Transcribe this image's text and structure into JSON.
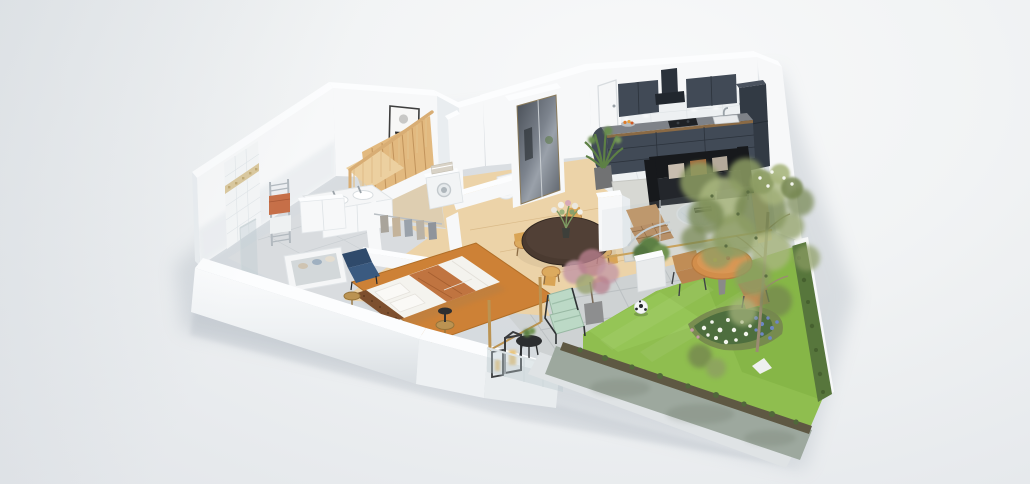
{
  "scene": {
    "label": "3D cutaway floor plan render of a one-bedroom apartment with terrace and private garden, isometric bird's-eye view on a light grey studio background",
    "rooms": {
      "kitchen": {
        "label": "Kitchen",
        "objects": [
          "dark slate fitted cabinets",
          "upper cabinets",
          "extractor hood",
          "cooktop",
          "sink with faucet",
          "tall fridge unit",
          "white tile backsplash with spotlights",
          "fruit bowl",
          "white tiled floor"
        ]
      },
      "entry": {
        "label": "Entry hall",
        "objects": [
          "white entrance door",
          "mirrored sliding wardrobe",
          "tall potted plant",
          "oak floor"
        ]
      },
      "dining_area": {
        "label": "Dining area",
        "objects": [
          "round espresso dining table",
          "four light wood chairs",
          "flower bouquet"
        ]
      },
      "living_room": {
        "label": "Living room",
        "objects": [
          "black three-seat sofa",
          "beige and cognac pillows",
          "round glass coffee table",
          "tan lounge chair",
          "light grey rug",
          "white column",
          "glass sliding wall"
        ]
      },
      "bedroom": {
        "label": "Bedroom",
        "objects": [
          "double bed with white duvet and terracotta throw",
          "brown tufted headboard",
          "orange rug",
          "dark blue armchair",
          "two brass side tables",
          "black table lamp",
          "white wardrobe"
        ]
      },
      "bathroom": {
        "label": "Bathroom",
        "objects": [
          "tiled shower wall with mosaic accent band",
          "glass shower screen",
          "towel radiator with orange and white towels",
          "double sink vanity",
          "bathtub with rolled towels",
          "grey tiled floor"
        ]
      },
      "wc": {
        "label": "WC",
        "objects": [
          "toilet"
        ]
      },
      "laundry": {
        "label": "Laundry nook",
        "objects": [
          "washing machine",
          "stack of folded towels"
        ]
      },
      "walk_in_closet": {
        "label": "Walk-in closet",
        "objects": [
          "clothes rail with hanging garments",
          "low white partition walls"
        ]
      },
      "staircase": {
        "label": "Staircase",
        "objects": [
          "light wood steps",
          "wood balustrade with balusters"
        ]
      },
      "terrace": {
        "label": "Terrace",
        "objects": [
          "concrete pavers",
          "mint green lounge chair",
          "black round side table",
          "two candle lanterns",
          "pink blossom potted tree",
          "white cube planter",
          "glass balustrade",
          "brass door frames",
          "round orange outdoor table",
          "two metal outdoor chairs"
        ]
      },
      "garden": {
        "label": "Garden",
        "objects": [
          "lawn",
          "flower bed with white and blue flowers",
          "large airy tree",
          "trimmed hedge",
          "soccer ball",
          "low concrete boundary wall with creeping plants",
          "white garden wall"
        ]
      }
    },
    "artwork": {
      "label": "Abstract wall art",
      "objects": [
        "grey circle",
        "black semicircle",
        "orange semicircle",
        "thin dark frame"
      ]
    }
  },
  "colors": {
    "wall_face": "#f7f8f9",
    "wall_side": "#e9edf0",
    "wall_top": "#fcfdfe",
    "floor_wood": "#ecd3a8",
    "floor_wood_dark": "#e2c491",
    "tile_white": "#eef1f2",
    "bath_floor": "#d9dcdf",
    "rug_living": "#d7d8d3",
    "rug_bedroom": "#cd8136",
    "kitchen_cabinet": "#414a56",
    "kitchen_cabinet_dark": "#323a44",
    "kitchen_counter": "#7e8288",
    "kitchen_hood": "#2b323b",
    "backsplash": "#edf0f2",
    "sofa_black": "#17191c",
    "sofa_cushion": "#23262b",
    "pillow_beige": "#c8bdaf",
    "pillow_cognac": "#a5693b",
    "chair_leather": "#b8895a",
    "bed_white": "#f4f3ee",
    "bed_throw": "#c07440",
    "headboard_brown": "#7d4f2e",
    "chair_blue": "#3a5a80",
    "brass": "#bb9352",
    "stairs_wood": "#e2b97f",
    "stairs_rail": "#d8ad74",
    "shower_tile": "#f3f5f6",
    "accent_tile": "#d9c79c",
    "towel_orange": "#c66f48",
    "towel_white": "#eef1f2",
    "porcelain": "#f5f6f7",
    "door_white": "#f6f7f8",
    "mirror_dark": "#5a6068",
    "art_black": "#2d2d2d",
    "art_orange": "#d2692b",
    "art_grey": "#c8c8c6",
    "lawn": "#8fbe4f",
    "lawn_dark": "#7fae42",
    "lawn_light": "#9ccb5e",
    "hedge": "#57763c",
    "soil": "#5e5843",
    "foliage": "#8d9d64",
    "foliage_dark": "#75864f",
    "foliage_light": "#a8b67e",
    "trunk": "#9b8b73",
    "flower_white": "#f4f6ee",
    "flower_blue": "#6d86c6",
    "flower_pink": "#c59aa6",
    "blossom_pink": "#b77f8d",
    "patio": "#ced2d3",
    "patio_line": "#bcc1c3",
    "mint": "#bcd9c6",
    "table_orange": "#d28e4b",
    "chair_outdoor": "#b9834f",
    "frame_dark": "#3f4246",
    "planter_white": "#e9ebec",
    "plant_green": "#5d8045",
    "lantern_dark": "#3a3c3e",
    "candle": "#e9c47b",
    "garden_wall": "#9aa59b",
    "garden_wall_light": "#dfe3e5",
    "pot_grey": "#8d8e8f",
    "metal": "#9aa2a8",
    "glass_tint": "#b9c9cd"
  }
}
